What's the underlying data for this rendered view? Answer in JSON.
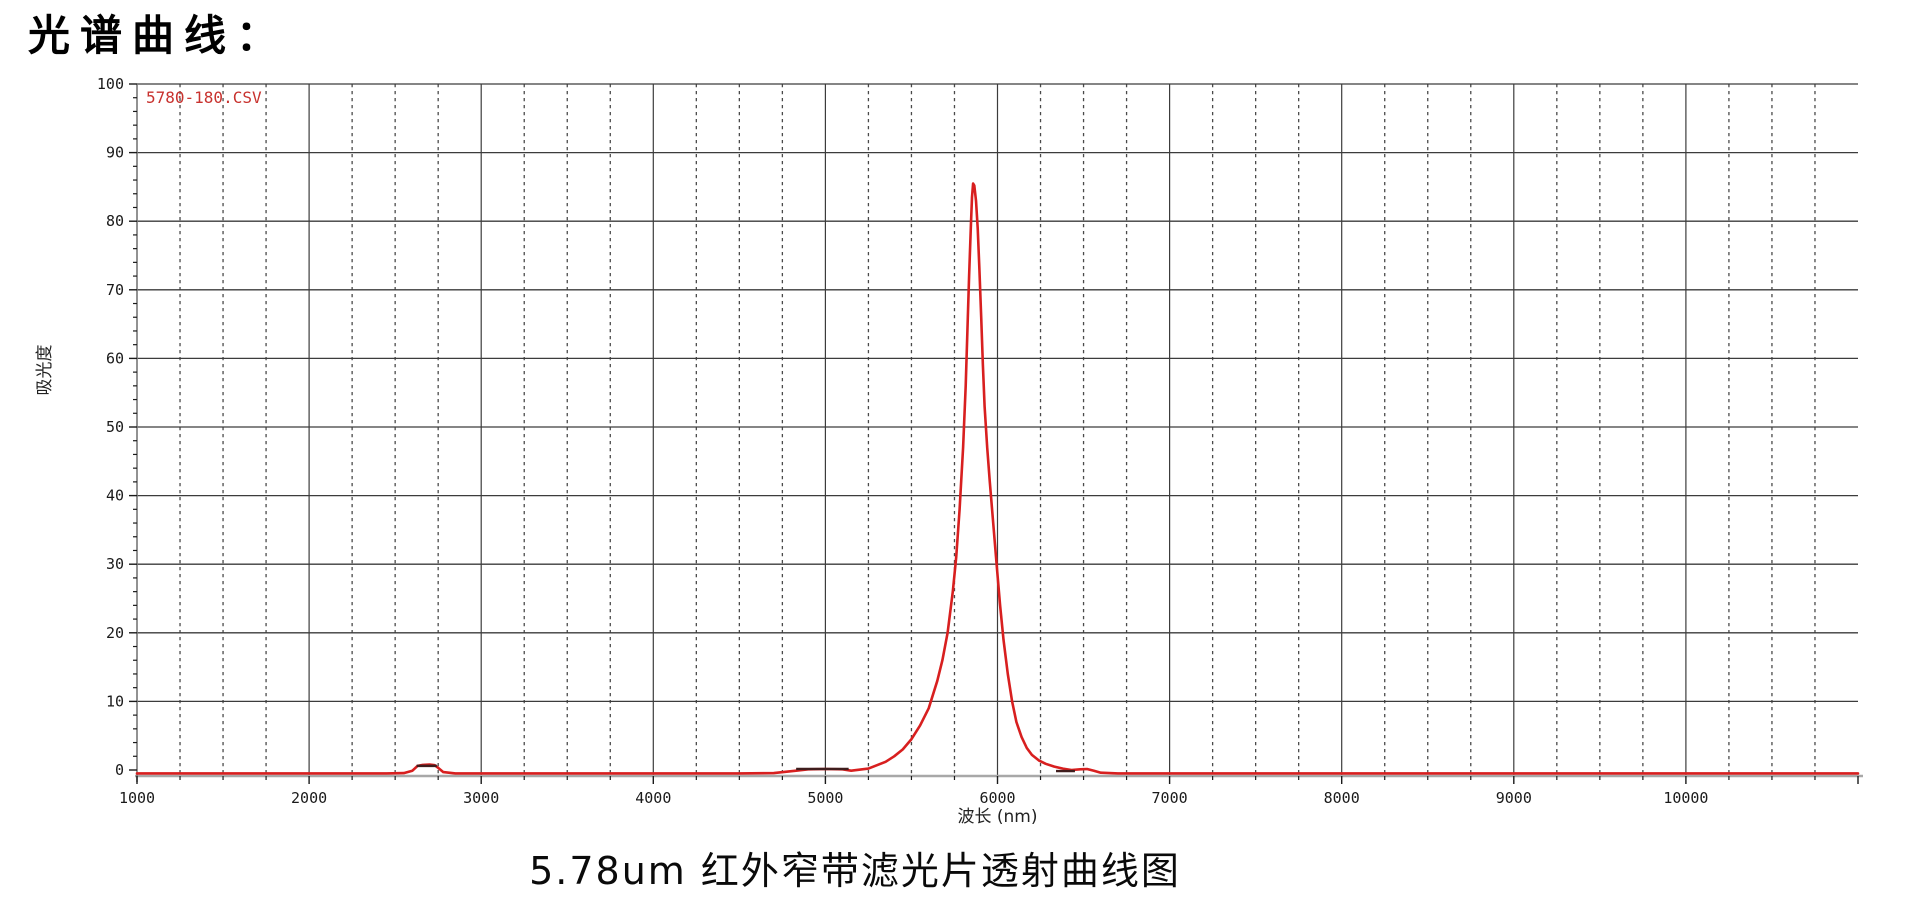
{
  "page": {
    "title": "光谱曲线：",
    "caption": "5.78um 红外窄带滤光片透射曲线图"
  },
  "chart_data": {
    "type": "line",
    "title": "光谱曲线：",
    "caption": "5.78um 红外窄带滤光片透射曲线图",
    "xlabel": "波长 (nm)",
    "ylabel": "吸光度",
    "xlim": [
      1000,
      11000
    ],
    "ylim": [
      0,
      100
    ],
    "legend": {
      "label": "5780-180.CSV",
      "position": "top-left",
      "color": "#c8322e"
    },
    "grid": {
      "horizontal_style": "solid",
      "vertical_major_style": "solid",
      "vertical_minor_style": "dashed",
      "color": "#3c3c3c",
      "minor_color": "#4a4a4a"
    },
    "axis_color": "#a8a8a8",
    "tick_color": "#1a1a1a",
    "x_major_tick_step": 1000,
    "x_minor_tick_step": 250,
    "y_major_tick_step": 10,
    "y_minor_tick_step": 2,
    "x_ticks": [
      {
        "value": 1000,
        "label": "1000"
      },
      {
        "value": 2000,
        "label": "2000"
      },
      {
        "value": 3000,
        "label": "3000"
      },
      {
        "value": 4000,
        "label": "4000"
      },
      {
        "value": 5000,
        "label": "5000"
      },
      {
        "value": 6000,
        "label": "6000"
      },
      {
        "value": 7000,
        "label": "7000"
      },
      {
        "value": 8000,
        "label": "8000"
      },
      {
        "value": 9000,
        "label": "9000"
      },
      {
        "value": 10000,
        "label": "10000"
      }
    ],
    "y_ticks": [
      {
        "value": 0,
        "label": "0"
      },
      {
        "value": 10,
        "label": "10"
      },
      {
        "value": 20,
        "label": "20"
      },
      {
        "value": 30,
        "label": "30"
      },
      {
        "value": 40,
        "label": "40"
      },
      {
        "value": 50,
        "label": "50"
      },
      {
        "value": 60,
        "label": "60"
      },
      {
        "value": 70,
        "label": "70"
      },
      {
        "value": 80,
        "label": "80"
      },
      {
        "value": 90,
        "label": "90"
      },
      {
        "value": 100,
        "label": "100"
      }
    ],
    "series": [
      {
        "name": "5780-180.CSV",
        "color": "#d81f1f",
        "peak": {
          "center_nm": 5858,
          "height_pct": 85.5,
          "fwhm_nm": 170
        },
        "points": [
          [
            1000,
            -0.5
          ],
          [
            1250,
            -0.5
          ],
          [
            1500,
            -0.5
          ],
          [
            1750,
            -0.5
          ],
          [
            2000,
            -0.5
          ],
          [
            2250,
            -0.5
          ],
          [
            2450,
            -0.5
          ],
          [
            2550,
            -0.45
          ],
          [
            2600,
            -0.1
          ],
          [
            2630,
            0.6
          ],
          [
            2660,
            0.75
          ],
          [
            2700,
            0.8
          ],
          [
            2730,
            0.7
          ],
          [
            2750,
            0.3
          ],
          [
            2780,
            -0.3
          ],
          [
            2850,
            -0.5
          ],
          [
            3000,
            -0.5
          ],
          [
            3250,
            -0.5
          ],
          [
            3500,
            -0.5
          ],
          [
            3750,
            -0.5
          ],
          [
            4000,
            -0.5
          ],
          [
            4250,
            -0.5
          ],
          [
            4500,
            -0.5
          ],
          [
            4700,
            -0.45
          ],
          [
            4830,
            -0.1
          ],
          [
            4900,
            0.1
          ],
          [
            5000,
            0.15
          ],
          [
            5100,
            0.1
          ],
          [
            5150,
            -0.1
          ],
          [
            5250,
            0.2
          ],
          [
            5300,
            0.7
          ],
          [
            5350,
            1.2
          ],
          [
            5400,
            2.0
          ],
          [
            5450,
            3.0
          ],
          [
            5500,
            4.5
          ],
          [
            5550,
            6.5
          ],
          [
            5600,
            9.0
          ],
          [
            5650,
            13
          ],
          [
            5680,
            16
          ],
          [
            5710,
            20
          ],
          [
            5740,
            26
          ],
          [
            5760,
            31
          ],
          [
            5780,
            38
          ],
          [
            5800,
            47
          ],
          [
            5815,
            56
          ],
          [
            5825,
            64
          ],
          [
            5835,
            72
          ],
          [
            5845,
            79
          ],
          [
            5852,
            83.5
          ],
          [
            5858,
            85.5
          ],
          [
            5865,
            85.2
          ],
          [
            5875,
            83
          ],
          [
            5885,
            79
          ],
          [
            5895,
            73
          ],
          [
            5905,
            66
          ],
          [
            5915,
            59
          ],
          [
            5925,
            53
          ],
          [
            5940,
            47
          ],
          [
            5955,
            42
          ],
          [
            5975,
            36
          ],
          [
            5995,
            30
          ],
          [
            6015,
            24
          ],
          [
            6035,
            19
          ],
          [
            6060,
            14
          ],
          [
            6085,
            10
          ],
          [
            6110,
            7
          ],
          [
            6140,
            4.8
          ],
          [
            6170,
            3.2
          ],
          [
            6200,
            2.2
          ],
          [
            6240,
            1.4
          ],
          [
            6280,
            0.9
          ],
          [
            6330,
            0.5
          ],
          [
            6380,
            0.2
          ],
          [
            6430,
            0.0
          ],
          [
            6480,
            0.1
          ],
          [
            6520,
            0.15
          ],
          [
            6560,
            -0.1
          ],
          [
            6600,
            -0.4
          ],
          [
            6700,
            -0.5
          ],
          [
            7000,
            -0.5
          ],
          [
            7500,
            -0.5
          ],
          [
            8000,
            -0.5
          ],
          [
            8500,
            -0.5
          ],
          [
            9000,
            -0.5
          ],
          [
            9500,
            -0.5
          ],
          [
            10000,
            -0.5
          ],
          [
            10500,
            -0.5
          ],
          [
            11000,
            -0.5
          ]
        ]
      }
    ],
    "overlay_dark_segments": [
      {
        "from_nm": 2625,
        "to_nm": 2742,
        "value": 0.6
      },
      {
        "from_nm": 4830,
        "to_nm": 5135,
        "value": 0.15
      },
      {
        "from_nm": 6340,
        "to_nm": 6450,
        "value": -0.15
      }
    ]
  }
}
